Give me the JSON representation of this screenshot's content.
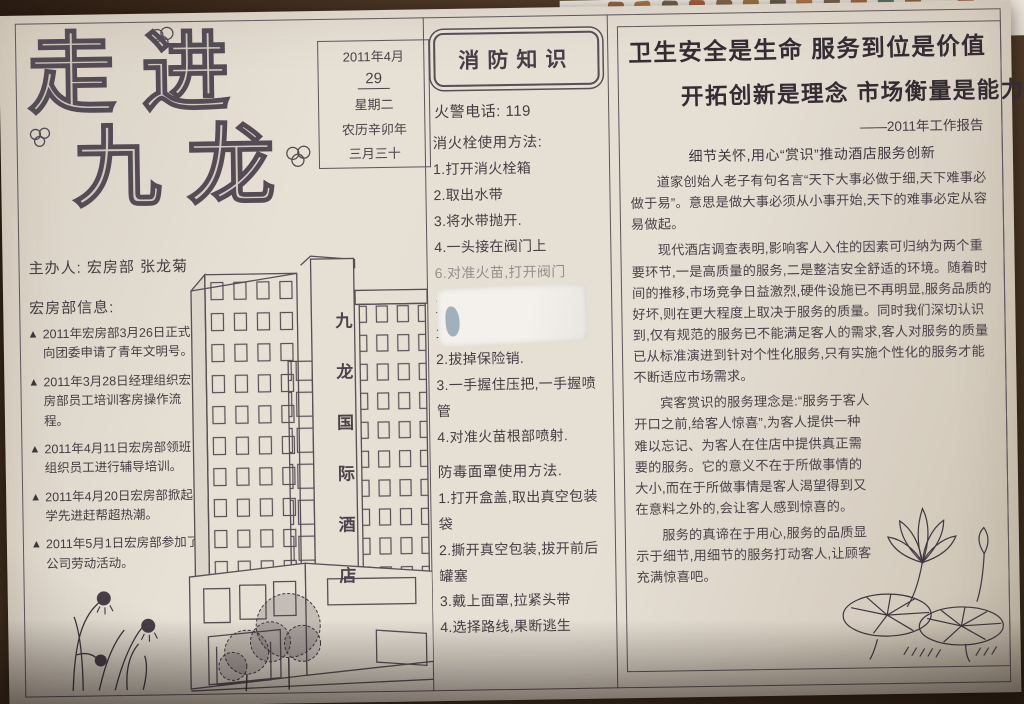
{
  "colors": {
    "paper": "#e6dfd4",
    "ink": "#453d43",
    "background": "#4a3523",
    "accent_stroke": "#534c55"
  },
  "left_column": {
    "title_line1": "走进",
    "title_line2": "九龙",
    "date_box": {
      "month": "2011年4月",
      "day": "29",
      "weekday": "星期二",
      "lunar_year": "农历辛卯年",
      "lunar_day": "三月三十"
    },
    "organizer": "主办人: 宏房部 张龙菊",
    "info_heading": "宏房部信息:",
    "bullet_marker": "▲",
    "bullets": [
      "2011年宏房部3月26日正式向团委申请了青年文明号。",
      "2011年3月28日经理组织宏房部员工培训客房操作流程。",
      "2011年4月11日宏房部领班组织员工进行辅导培训。",
      "2011年4月20日宏房部掀起学先进赶帮超热潮。",
      "2011年5月1日宏房部参加了公司劳动活动。"
    ],
    "building_sign": "九龙国际酒店"
  },
  "middle_column": {
    "header": "消防知识",
    "phone_line": "火警电话: 119",
    "hydrant": {
      "title": "消火栓使用方法:",
      "steps": [
        "1.打开消火栓箱",
        "2.取出水带",
        "3.将水带抛开.",
        "4.一头接在阀门上",
        "6.对准火苗,打开阀门"
      ]
    },
    "extinguisher": {
      "title": "灭火器使用方法:",
      "steps": [
        "1.取出灭火器.",
        "2.拔掉保险销.",
        "3.一手握住压把,一手握喷管",
        "4.对准火苗根部喷射."
      ]
    },
    "mask": {
      "title": "防毒面罩使用方法.",
      "steps": [
        "1.打开盒盖,取出真空包装袋",
        "2.撕开真空包装,拔开前后罐塞",
        "3.戴上面罩,拉紧头带",
        "4.选择路线,果断逃生"
      ]
    }
  },
  "right_column": {
    "headline1": "卫生安全是生命 服务到位是价值",
    "headline2": "开拓创新是理念 市场衡量是能力",
    "attribution": "——2011年工作报告",
    "subtitle": "细节关怀,用心“赏识”推动酒店服务创新",
    "paragraphs": [
      "道家创始人老子有句名言“天下大事必做于细,天下难事必做于易”。意思是做大事必须从小事开始,天下的难事必定从容易做起。",
      "现代酒店调查表明,影响客人入住的因素可归纳为两个重要环节,一是高质量的服务,二是整洁安全舒适的环境。随着时间的推移,市场竞争日益激烈,硬件设施已不再明显,服务品质的好坏,则在更大程度上取决于服务的质量。同时我们深切认识到,仅有规范的服务已不能满足客人的需求,客人对服务的质量已从标准演进到针对个性化服务,只有实施个性化的服务才能不断适应市场需求。",
      "宾客赏识的服务理念是:“服务于客人开口之前,给客人惊喜”,为客人提供一种难以忘记、为客人在住店中提供真正需要的服务。它的意义不在于所做事情的大小,而在于所做事情是客人渴望得到又在意料之外的,会让客人感到惊喜的。",
      "服务的真谛在于用心,服务的品质显示于细节,用细节的服务打动客人,让顾客充满惊喜吧。"
    ]
  }
}
